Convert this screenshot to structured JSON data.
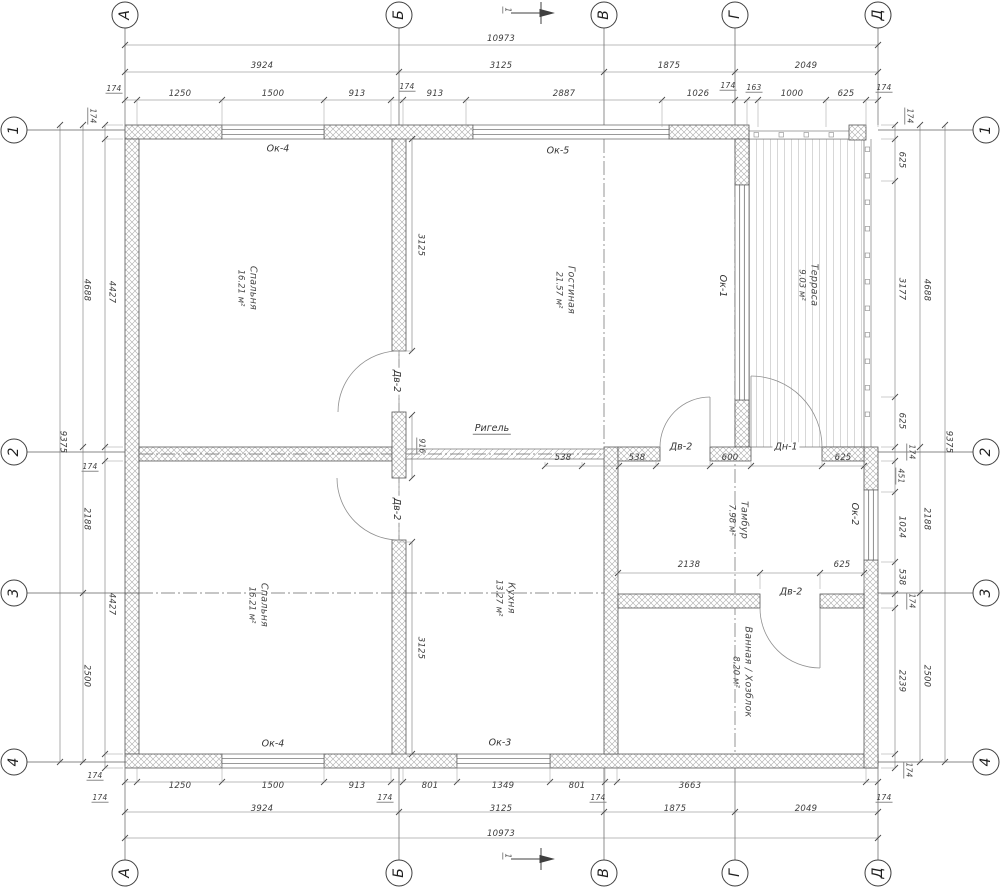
{
  "axes": {
    "bubble_top_y": 15,
    "bubble_bottom_y": 873,
    "bubble_left_x": 14,
    "bubble_right_x": 986,
    "cols": [
      {
        "label": "А",
        "x": 125
      },
      {
        "label": "Б",
        "x": 399
      },
      {
        "label": "В",
        "x": 604
      },
      {
        "label": "Г",
        "x": 735
      },
      {
        "label": "Д",
        "x": 878
      }
    ],
    "rows": [
      {
        "label": "1",
        "y": 130
      },
      {
        "label": "2",
        "y": 452
      },
      {
        "label": "3",
        "y": 593
      },
      {
        "label": "4",
        "y": 762
      }
    ]
  },
  "rooms": [
    {
      "name": "Спальня",
      "area": "16.21 м²",
      "x": 247,
      "y": 288
    },
    {
      "name": "Гостиная",
      "area": "21.57 м²",
      "x": 565,
      "y": 290
    },
    {
      "name": "Терраса",
      "area": "9.03 м²",
      "x": 808,
      "y": 285
    },
    {
      "name": "Спальня",
      "area": "16.21 м²",
      "x": 258,
      "y": 605
    },
    {
      "name": "Кухня",
      "area": "13.27 м²",
      "x": 505,
      "y": 598
    },
    {
      "name": "Тамбур",
      "area": "7.98 м²",
      "x": 738,
      "y": 520
    },
    {
      "name": "Ванная / Хозблок",
      "area": "8.20 м²",
      "x": 742,
      "y": 672
    }
  ],
  "labels": [
    {
      "n": "dim-top-overall",
      "t": "10973",
      "x": 501,
      "y": 39
    },
    {
      "n": "dim-top-a-b",
      "t": "3924",
      "x": 262,
      "y": 66
    },
    {
      "n": "dim-top-b-v",
      "t": "3125",
      "x": 501,
      "y": 66
    },
    {
      "n": "dim-top-v-g",
      "t": "1875",
      "x": 669,
      "y": 66
    },
    {
      "n": "dim-top-g-d",
      "t": "2049",
      "x": 806,
      "y": 66
    },
    {
      "n": "dim-top-wall",
      "t": "174",
      "x": 114,
      "y": 89,
      "s": "dim sm"
    },
    {
      "n": "dim-top-seg",
      "t": "1250",
      "x": 180,
      "y": 94
    },
    {
      "n": "dim-top-seg",
      "t": "1500",
      "x": 273,
      "y": 94
    },
    {
      "n": "dim-top-seg",
      "t": "913",
      "x": 357,
      "y": 94
    },
    {
      "n": "dim-top-wall",
      "t": "174",
      "x": 407,
      "y": 87,
      "s": "dim sm"
    },
    {
      "n": "dim-top-seg",
      "t": "913",
      "x": 435,
      "y": 94
    },
    {
      "n": "dim-top-seg",
      "t": "2887",
      "x": 564,
      "y": 94
    },
    {
      "n": "dim-top-seg",
      "t": "1026",
      "x": 698,
      "y": 94
    },
    {
      "n": "dim-top-wall",
      "t": "174",
      "x": 728,
      "y": 86,
      "s": "dim sm"
    },
    {
      "n": "dim-top-seg",
      "t": "163",
      "x": 754,
      "y": 88,
      "s": "dim sm"
    },
    {
      "n": "dim-top-seg",
      "t": "1000",
      "x": 792,
      "y": 94
    },
    {
      "n": "dim-top-seg",
      "t": "625",
      "x": 846,
      "y": 94
    },
    {
      "n": "dim-top-wall",
      "t": "174",
      "x": 884,
      "y": 88,
      "s": "dim sm"
    },
    {
      "n": "dim-bottom-wall",
      "t": "174",
      "x": 100,
      "y": 798,
      "s": "dim sm"
    },
    {
      "n": "dim-bottom-seg",
      "t": "1250",
      "x": 180,
      "y": 786
    },
    {
      "n": "dim-bottom-seg",
      "t": "1500",
      "x": 273,
      "y": 786
    },
    {
      "n": "dim-bottom-seg",
      "t": "913",
      "x": 357,
      "y": 786
    },
    {
      "n": "dim-bottom-wall",
      "t": "174",
      "x": 385,
      "y": 798,
      "s": "dim sm"
    },
    {
      "n": "dim-bottom-seg",
      "t": "801",
      "x": 430,
      "y": 786
    },
    {
      "n": "dim-bottom-seg",
      "t": "1349",
      "x": 503,
      "y": 786
    },
    {
      "n": "dim-bottom-seg",
      "t": "801",
      "x": 577,
      "y": 786
    },
    {
      "n": "dim-bottom-wall",
      "t": "174",
      "x": 598,
      "y": 798,
      "s": "dim sm"
    },
    {
      "n": "dim-bottom-seg",
      "t": "3663",
      "x": 690,
      "y": 786
    },
    {
      "n": "dim-bottom-wall",
      "t": "174",
      "x": 884,
      "y": 798,
      "s": "dim sm"
    },
    {
      "n": "dim-bottom-a-b",
      "t": "3924",
      "x": 262,
      "y": 809
    },
    {
      "n": "dim-bottom-b-v",
      "t": "3125",
      "x": 501,
      "y": 809
    },
    {
      "n": "dim-bottom-v-g",
      "t": "1875",
      "x": 675,
      "y": 809
    },
    {
      "n": "dim-bottom-g-d",
      "t": "2049",
      "x": 806,
      "y": 809
    },
    {
      "n": "dim-bottom-overall",
      "t": "10973",
      "x": 501,
      "y": 834
    },
    {
      "n": "dim-left-wall",
      "t": "174",
      "x": 92,
      "y": 116,
      "r": 90,
      "s": "dim sm"
    },
    {
      "n": "dim-left-seg",
      "t": "4427",
      "x": 111,
      "y": 292,
      "r": 90
    },
    {
      "n": "dim-left-1-2",
      "t": "4688",
      "x": 86,
      "y": 290,
      "r": 90
    },
    {
      "n": "dim-left-overall",
      "t": "9375",
      "x": 62,
      "y": 442,
      "r": 90
    },
    {
      "n": "dim-left-wall",
      "t": "174",
      "x": 90,
      "y": 467,
      "s": "dim sm"
    },
    {
      "n": "dim-left-2-3",
      "t": "2188",
      "x": 86,
      "y": 519,
      "r": 90
    },
    {
      "n": "dim-left-seg",
      "t": "4427",
      "x": 111,
      "y": 604,
      "r": 90
    },
    {
      "n": "dim-left-3-4",
      "t": "2500",
      "x": 86,
      "y": 676,
      "r": 90
    },
    {
      "n": "dim-left-wall",
      "t": "174",
      "x": 95,
      "y": 776,
      "s": "dim sm"
    },
    {
      "n": "dim-right-wall",
      "t": "174",
      "x": 909,
      "y": 116,
      "r": 90,
      "s": "dim sm"
    },
    {
      "n": "dim-right-seg",
      "t": "625",
      "x": 901,
      "y": 160,
      "r": 90
    },
    {
      "n": "dim-right-seg",
      "t": "3177",
      "x": 901,
      "y": 289,
      "r": 90
    },
    {
      "n": "dim-right-seg",
      "t": "625",
      "x": 901,
      "y": 421,
      "r": 90
    },
    {
      "n": "dim-right-wall",
      "t": "174",
      "x": 911,
      "y": 452,
      "r": 90,
      "s": "dim sm"
    },
    {
      "n": "dim-right-seg",
      "t": "451",
      "x": 900,
      "y": 476,
      "r": 90,
      "s": "dim sm"
    },
    {
      "n": "dim-right-seg",
      "t": "1024",
      "x": 901,
      "y": 527,
      "r": 90
    },
    {
      "n": "dim-right-seg",
      "t": "538",
      "x": 901,
      "y": 577,
      "r": 90
    },
    {
      "n": "dim-right-wall",
      "t": "174",
      "x": 911,
      "y": 601,
      "r": 90,
      "s": "dim sm"
    },
    {
      "n": "dim-right-seg",
      "t": "2239",
      "x": 901,
      "y": 681,
      "r": 90
    },
    {
      "n": "dim-right-wall",
      "t": "174",
      "x": 908,
      "y": 770,
      "r": 90,
      "s": "dim sm"
    },
    {
      "n": "dim-right-1-2",
      "t": "4688",
      "x": 926,
      "y": 290,
      "r": 90
    },
    {
      "n": "dim-right-2-3",
      "t": "2188",
      "x": 926,
      "y": 519,
      "r": 90
    },
    {
      "n": "dim-right-3-4",
      "t": "2500",
      "x": 926,
      "y": 676,
      "r": 90
    },
    {
      "n": "dim-right-overall",
      "t": "9375",
      "x": 948,
      "y": 442,
      "r": 90
    },
    {
      "n": "dim-interior",
      "t": "3125",
      "x": 420,
      "y": 245,
      "r": 90
    },
    {
      "n": "dim-interior",
      "t": "916",
      "x": 421,
      "y": 446,
      "r": 90,
      "s": "dim sm"
    },
    {
      "n": "dim-interior",
      "t": "3125",
      "x": 420,
      "y": 648,
      "r": 90
    },
    {
      "n": "dim-interior",
      "t": "538",
      "x": 563,
      "y": 458
    },
    {
      "n": "dim-interior",
      "t": "538",
      "x": 637,
      "y": 458
    },
    {
      "n": "dim-interior",
      "t": "600",
      "x": 730,
      "y": 458
    },
    {
      "n": "dim-interior",
      "t": "625",
      "x": 843,
      "y": 458
    },
    {
      "n": "dim-interior",
      "t": "2138",
      "x": 689,
      "y": 565
    },
    {
      "n": "dim-interior",
      "t": "625",
      "x": 842,
      "y": 565
    },
    {
      "n": "window-tag",
      "t": "Ок-4",
      "x": 278,
      "y": 149,
      "s": "tag"
    },
    {
      "n": "window-tag",
      "t": "Ок-5",
      "x": 558,
      "y": 151,
      "s": "tag"
    },
    {
      "n": "window-tag",
      "t": "Ок-1",
      "x": 722,
      "y": 286,
      "r": 90,
      "s": "tag"
    },
    {
      "n": "window-tag",
      "t": "Ок-2",
      "x": 854,
      "y": 514,
      "r": 90,
      "s": "tag"
    },
    {
      "n": "window-tag",
      "t": "Ок-4",
      "x": 273,
      "y": 744,
      "s": "tag"
    },
    {
      "n": "window-tag",
      "t": "Ок-3",
      "x": 500,
      "y": 743,
      "s": "tag"
    },
    {
      "n": "door-tag",
      "t": "Дв-2",
      "x": 396,
      "y": 381,
      "r": 90,
      "s": "tag"
    },
    {
      "n": "door-tag",
      "t": "Дв-2",
      "x": 396,
      "y": 509,
      "r": 90,
      "s": "tag"
    },
    {
      "n": "door-tag",
      "t": "Дв-2",
      "x": 681,
      "y": 447,
      "s": "tag"
    },
    {
      "n": "door-tag",
      "t": "Дн-1",
      "x": 786,
      "y": 447,
      "s": "tag"
    },
    {
      "n": "door-tag",
      "t": "Дв-2",
      "x": 791,
      "y": 592,
      "s": "tag"
    },
    {
      "n": "beam-tag",
      "t": "Ригель",
      "x": 492,
      "y": 429,
      "s": "tag u"
    },
    {
      "n": "section-number",
      "t": "1",
      "x": 507,
      "y": 10,
      "r": 90,
      "s": "dim sm"
    },
    {
      "n": "section-number",
      "t": "1",
      "x": 507,
      "y": 856,
      "r": 90,
      "s": "dim sm"
    }
  ]
}
